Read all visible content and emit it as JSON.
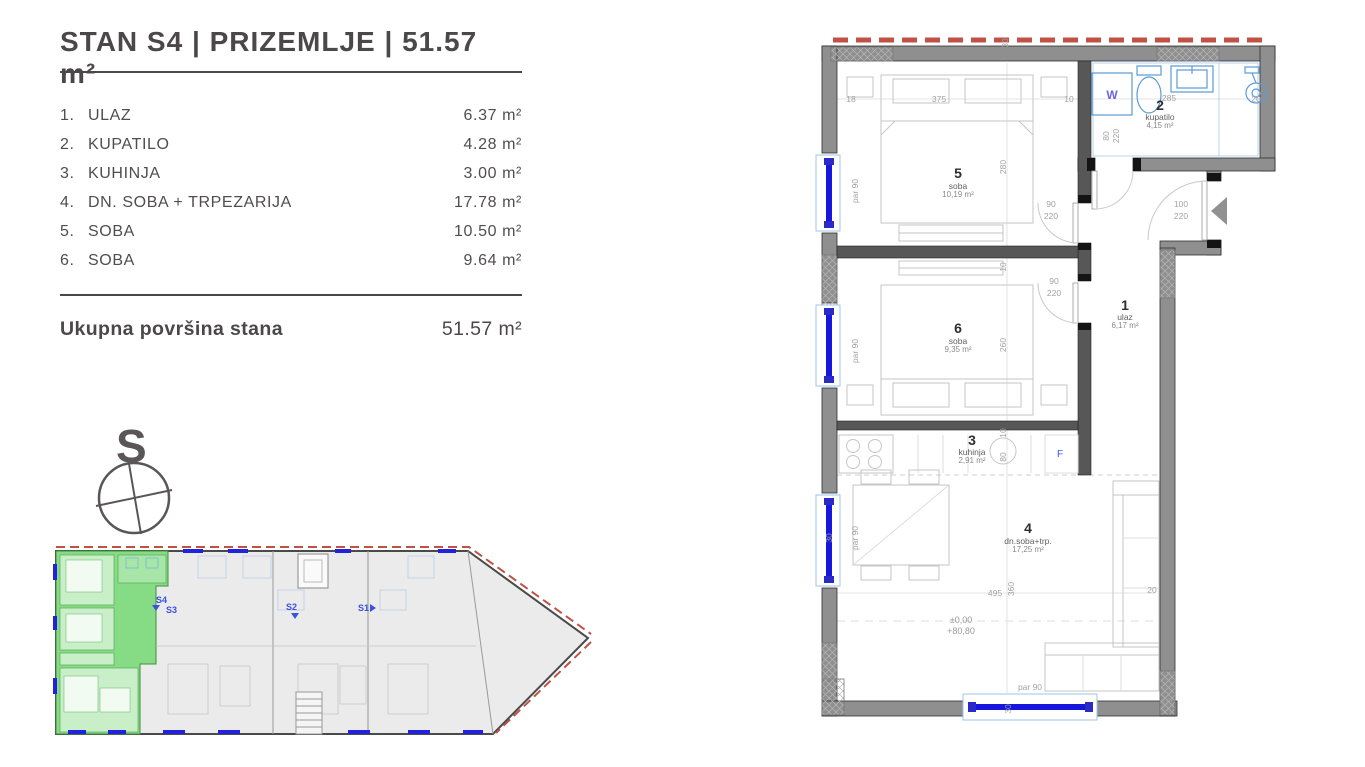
{
  "header": {
    "title": "STAN S4 | PRIZEMLJE | 51.57 m²"
  },
  "room_list": {
    "items": [
      {
        "num": "1.",
        "name": "ULAZ",
        "area": "6.37 m²"
      },
      {
        "num": "2.",
        "name": "KUPATILO",
        "area": "4.28 m²"
      },
      {
        "num": "3.",
        "name": "KUHINJA",
        "area": "3.00 m²"
      },
      {
        "num": "4.",
        "name": "DN. SOBA + TRPEZARIJA",
        "area": "17.78 m²"
      },
      {
        "num": "5.",
        "name": "SOBA",
        "area": "10.50 m²"
      },
      {
        "num": "6.",
        "name": "SOBA",
        "area": "9.64 m²"
      }
    ],
    "total_label": "Ukupna površina stana",
    "total_value": "51.57 m²"
  },
  "compass": {
    "letter": "S"
  },
  "floor_plan": {
    "rooms": {
      "r1": {
        "num": "1",
        "name": "ulaz",
        "area": "6,17 m²"
      },
      "r2": {
        "num": "2",
        "name": "kupatilo",
        "area": "4,15 m²"
      },
      "r3": {
        "num": "3",
        "name": "kuhinja",
        "area": "2,91 m²"
      },
      "r4": {
        "num": "4",
        "name": "dn.soba+trp.",
        "area": "17,25 m²"
      },
      "r5": {
        "num": "5",
        "name": "soba",
        "area": "10,19 m²"
      },
      "r6": {
        "num": "6",
        "name": "soba",
        "area": "9,35 m²"
      }
    },
    "appliances": {
      "washer": "W",
      "fridge": "F"
    },
    "levels": {
      "zero": "±0,00",
      "height": "+80,80"
    },
    "dims": {
      "par90": "par 90",
      "d10": "10",
      "d18": "18",
      "d20": "20",
      "d30": "30",
      "d80": "80",
      "d90": "90",
      "d100": "100",
      "d220": "220",
      "d260": "260",
      "d280": "280",
      "d285": "285",
      "d360": "360",
      "d375": "375",
      "d495": "495"
    }
  },
  "overview": {
    "units": [
      {
        "label": "S4"
      },
      {
        "label": "S3"
      },
      {
        "label": "S2"
      },
      {
        "label": "S1"
      }
    ]
  },
  "colors": {
    "text_dark": "#4c4849",
    "wall_gray": "#8f8f8f",
    "window_blue": "#1616dd",
    "fixture_blue": "#5b9bd5",
    "unit_green": "#85dc85",
    "label_blue": "#3a52e0",
    "red_dash": "#bf5145",
    "dim_gray": "#a2a2a2"
  }
}
